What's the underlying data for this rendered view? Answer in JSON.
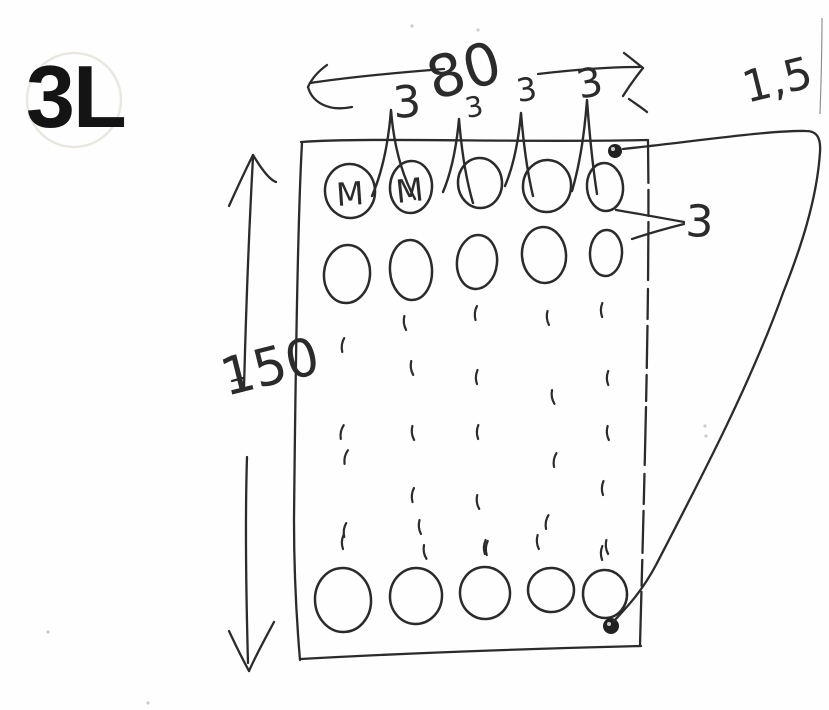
{
  "page": {
    "drawing_number": "3L",
    "background": "#fefefe",
    "ink": "#2b2b2b"
  },
  "dimensions": {
    "top_width": "80",
    "left_height": "150",
    "thickness": "1,5",
    "row_spacing": "3",
    "pitch_labels": [
      "3",
      "3",
      "3",
      "3"
    ]
  },
  "plate": {
    "hole_marks": [
      "M",
      "M"
    ],
    "columns": 5,
    "holes_row1": [
      [
        350,
        191,
        25,
        27,
        -6
      ],
      [
        411,
        187,
        21,
        26,
        4
      ],
      [
        480,
        183,
        22,
        25,
        -3
      ],
      [
        547,
        186,
        24,
        26,
        5
      ],
      [
        605,
        187,
        18,
        24,
        -5
      ]
    ],
    "holes_row2": [
      [
        347,
        274,
        23,
        29,
        5
      ],
      [
        411,
        270,
        21,
        30,
        -4
      ],
      [
        477,
        262,
        20,
        27,
        6
      ],
      [
        544,
        255,
        22,
        28,
        -5
      ],
      [
        606,
        253,
        16,
        23,
        3
      ]
    ],
    "holes_bottom": [
      [
        343,
        600,
        28,
        32,
        -4
      ],
      [
        416,
        596,
        26,
        28,
        5
      ],
      [
        485,
        593,
        25,
        26,
        -6
      ],
      [
        551,
        590,
        23,
        22,
        4
      ],
      [
        605,
        594,
        22,
        24,
        -3
      ]
    ],
    "ticks": [
      [
        405,
        323,
        -5
      ],
      [
        476,
        313,
        8
      ],
      [
        548,
        318,
        -4
      ],
      [
        602,
        310,
        3
      ],
      [
        343,
        345,
        10
      ],
      [
        412,
        368,
        -6
      ],
      [
        477,
        377,
        4
      ],
      [
        553,
        397,
        -8
      ],
      [
        608,
        378,
        2
      ],
      [
        342,
        432,
        14
      ],
      [
        346,
        457,
        16
      ],
      [
        413,
        433,
        -5
      ],
      [
        478,
        432,
        3
      ],
      [
        555,
        460,
        12
      ],
      [
        608,
        433,
        -3
      ],
      [
        413,
        495,
        8
      ],
      [
        478,
        502,
        -6
      ],
      [
        603,
        488,
        4
      ],
      [
        345,
        530,
        10
      ],
      [
        420,
        527,
        -4
      ],
      [
        487,
        548,
        6
      ],
      [
        547,
        522,
        12
      ],
      [
        607,
        547,
        -5
      ],
      [
        343,
        542,
        4
      ],
      [
        425,
        552,
        -8
      ],
      [
        485,
        547,
        5
      ],
      [
        538,
        542,
        -3
      ],
      [
        602,
        553,
        3
      ]
    ],
    "peaks": [
      [
        372,
        196,
        391,
        110,
        415,
        199
      ],
      [
        443,
        192,
        459,
        119,
        473,
        203
      ],
      [
        505,
        186,
        521,
        113,
        533,
        196
      ],
      [
        572,
        191,
        587,
        100,
        597,
        194
      ]
    ],
    "corner_dots": [
      [
        615,
        151,
        7
      ],
      [
        611,
        626,
        8
      ]
    ],
    "specks": [
      [
        48,
        632
      ],
      [
        705,
        426
      ],
      [
        706,
        436
      ],
      [
        412,
        26
      ],
      [
        478,
        30
      ],
      [
        148,
        703
      ]
    ]
  }
}
